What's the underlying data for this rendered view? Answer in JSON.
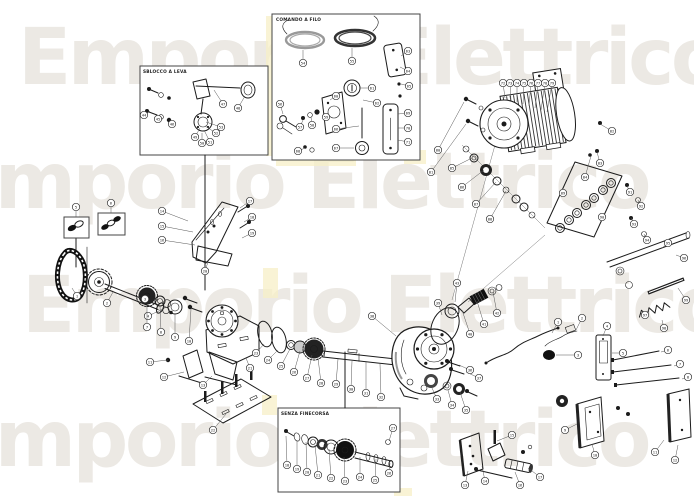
{
  "watermark": {
    "text": "Emporio Elettrico",
    "color": "#ece9e4"
  },
  "insets": [
    {
      "id": "lever-release",
      "label": "SBLOCCO A LEVA"
    },
    {
      "id": "cable-release",
      "label": "COMANDO A FILO"
    },
    {
      "id": "no-limit-switch",
      "label": "SENZA FINECORSA"
    }
  ],
  "diagram": {
    "kind": "exploded-parts-diagram",
    "line_color": "#1b1b1b",
    "highlight_color": "#f7efc7"
  },
  "balloons": [
    {
      "n": "1",
      "x": 77,
      "y": 296,
      "l": [
        72,
        288
      ]
    },
    {
      "n": "2",
      "x": 107,
      "y": 303,
      "l": [
        113,
        292
      ]
    },
    {
      "n": "3",
      "x": 145,
      "y": 299,
      "l": [
        136,
        297
      ]
    },
    {
      "n": "4",
      "x": 148,
      "y": 316,
      "l": [
        163,
        309
      ]
    },
    {
      "n": "5",
      "x": 76,
      "y": 207,
      "l": [
        76,
        217
      ]
    },
    {
      "n": "6",
      "x": 111,
      "y": 203,
      "l": [
        111,
        213
      ]
    },
    {
      "n": "7",
      "x": 147,
      "y": 327,
      "l": [
        147,
        306
      ]
    },
    {
      "n": "8",
      "x": 161,
      "y": 332,
      "l": [
        160,
        306
      ]
    },
    {
      "n": "9",
      "x": 175,
      "y": 337,
      "l": [
        175,
        314
      ]
    },
    {
      "n": "10",
      "x": 189,
      "y": 341,
      "l": [
        191,
        309
      ]
    },
    {
      "n": "11",
      "x": 150,
      "y": 362,
      "l": [
        168,
        360
      ]
    },
    {
      "n": "12",
      "x": 164,
      "y": 377,
      "l": [
        184,
        372
      ]
    },
    {
      "n": "13",
      "x": 203,
      "y": 385,
      "l": [
        212,
        376
      ]
    },
    {
      "n": "14",
      "x": 162,
      "y": 211,
      "l": [
        188,
        221
      ]
    },
    {
      "n": "15",
      "x": 162,
      "y": 226,
      "l": [
        193,
        232
      ]
    },
    {
      "n": "16",
      "x": 162,
      "y": 240,
      "l": [
        195,
        245
      ]
    },
    {
      "n": "17",
      "x": 250,
      "y": 201,
      "l": [
        240,
        208
      ]
    },
    {
      "n": "18",
      "x": 252,
      "y": 217,
      "l": [
        244,
        222
      ]
    },
    {
      "n": "19",
      "x": 252,
      "y": 233,
      "l": [
        242,
        238
      ]
    },
    {
      "n": "20",
      "x": 205,
      "y": 271,
      "l": [
        208,
        262
      ]
    },
    {
      "n": "21",
      "x": 250,
      "y": 368,
      "l": [
        246,
        358
      ]
    },
    {
      "n": "22",
      "x": 213,
      "y": 430,
      "l": [
        226,
        414
      ]
    },
    {
      "n": "23",
      "x": 256,
      "y": 353,
      "l": [
        264,
        344
      ]
    },
    {
      "n": "24",
      "x": 268,
      "y": 360,
      "l": [
        278,
        350
      ]
    },
    {
      "n": "25",
      "x": 281,
      "y": 366,
      "l": [
        290,
        349
      ]
    },
    {
      "n": "26",
      "x": 294,
      "y": 372,
      "l": [
        300,
        351
      ]
    },
    {
      "n": "27",
      "x": 307,
      "y": 378,
      "l": [
        312,
        355
      ]
    },
    {
      "n": "28",
      "x": 321,
      "y": 383,
      "l": [
        318,
        358
      ]
    },
    {
      "n": "29",
      "x": 336,
      "y": 384,
      "l": [
        338,
        359
      ]
    },
    {
      "n": "30",
      "x": 351,
      "y": 389,
      "l": [
        352,
        361
      ]
    },
    {
      "n": "31",
      "x": 366,
      "y": 393,
      "l": [
        366,
        362
      ]
    },
    {
      "n": "32",
      "x": 381,
      "y": 397,
      "l": [
        380,
        364
      ]
    },
    {
      "n": "33",
      "x": 437,
      "y": 399,
      "l": [
        432,
        388
      ]
    },
    {
      "n": "34",
      "x": 452,
      "y": 405,
      "l": [
        448,
        390
      ]
    },
    {
      "n": "35",
      "x": 466,
      "y": 410,
      "l": [
        460,
        392
      ]
    },
    {
      "n": "36",
      "x": 470,
      "y": 370,
      "l": [
        459,
        365
      ]
    },
    {
      "n": "37",
      "x": 479,
      "y": 378,
      "l": [
        466,
        372
      ]
    },
    {
      "n": "38",
      "x": 372,
      "y": 316,
      "l": [
        396,
        336
      ]
    },
    {
      "n": "39",
      "x": 438,
      "y": 303,
      "l": [
        442,
        315
      ]
    },
    {
      "n": "40",
      "x": 470,
      "y": 334,
      "l": [
        462,
        310
      ]
    },
    {
      "n": "41",
      "x": 484,
      "y": 324,
      "l": [
        477,
        301
      ]
    },
    {
      "n": "42",
      "x": 497,
      "y": 313,
      "l": [
        493,
        292
      ]
    },
    {
      "n": "43",
      "x": 457,
      "y": 283,
      "l": [
        455,
        302
      ]
    },
    {
      "n": "44",
      "x": 144,
      "y": 115,
      "l": [
        150,
        111
      ]
    },
    {
      "n": "45",
      "x": 158,
      "y": 119,
      "l": [
        161,
        116
      ]
    },
    {
      "n": "46",
      "x": 172,
      "y": 124,
      "l": [
        170,
        120
      ]
    },
    {
      "n": "47",
      "x": 223,
      "y": 104,
      "l": [
        214,
        90
      ]
    },
    {
      "n": "48",
      "x": 238,
      "y": 108,
      "l": [
        245,
        96
      ]
    },
    {
      "n": "49",
      "x": 195,
      "y": 137,
      "l": [
        200,
        128
      ]
    },
    {
      "n": "50",
      "x": 202,
      "y": 143,
      "l": [
        202,
        133
      ]
    },
    {
      "n": "51",
      "x": 210,
      "y": 142,
      "l": [
        204,
        130
      ]
    },
    {
      "n": "52",
      "x": 216,
      "y": 133,
      "l": [
        205,
        126
      ]
    },
    {
      "n": "53",
      "x": 221,
      "y": 127,
      "l": [
        206,
        122
      ]
    },
    {
      "n": "54",
      "x": 303,
      "y": 63,
      "l": [
        303,
        50
      ]
    },
    {
      "n": "55",
      "x": 352,
      "y": 61,
      "l": [
        352,
        48
      ]
    },
    {
      "n": "56",
      "x": 280,
      "y": 104,
      "l": [
        283,
        114
      ]
    },
    {
      "n": "57",
      "x": 300,
      "y": 127,
      "l": [
        303,
        120
      ]
    },
    {
      "n": "58",
      "x": 312,
      "y": 125,
      "l": [
        311,
        117
      ]
    },
    {
      "n": "59",
      "x": 326,
      "y": 117
    },
    {
      "n": "60",
      "x": 336,
      "y": 96,
      "l": [
        330,
        100
      ]
    },
    {
      "n": "61",
      "x": 372,
      "y": 88,
      "l": [
        360,
        88
      ]
    },
    {
      "n": "62",
      "x": 377,
      "y": 103,
      "l": [
        363,
        100
      ]
    },
    {
      "n": "63",
      "x": 408,
      "y": 51,
      "l": [
        401,
        56
      ]
    },
    {
      "n": "64",
      "x": 408,
      "y": 71,
      "l": [
        400,
        67
      ]
    },
    {
      "n": "65",
      "x": 409,
      "y": 86,
      "l": [
        401,
        84
      ]
    },
    {
      "n": "66",
      "x": 336,
      "y": 129,
      "l": [
        359,
        126
      ]
    },
    {
      "n": "67",
      "x": 336,
      "y": 148,
      "l": [
        354,
        148
      ]
    },
    {
      "n": "68",
      "x": 298,
      "y": 151,
      "l": [
        305,
        148
      ]
    },
    {
      "n": "69",
      "x": 408,
      "y": 113,
      "l": [
        398,
        114
      ]
    },
    {
      "n": "70",
      "x": 408,
      "y": 128,
      "l": [
        398,
        128
      ]
    },
    {
      "n": "71",
      "x": 408,
      "y": 142,
      "l": [
        398,
        140
      ]
    },
    {
      "n": "72",
      "x": 503,
      "y": 83,
      "l": [
        505,
        98
      ]
    },
    {
      "n": "73",
      "x": 510,
      "y": 83,
      "l": [
        511,
        100
      ]
    },
    {
      "n": "74",
      "x": 517,
      "y": 83,
      "l": [
        517,
        102
      ]
    },
    {
      "n": "75",
      "x": 524,
      "y": 83,
      "l": [
        523,
        104
      ]
    },
    {
      "n": "76",
      "x": 531,
      "y": 83,
      "l": [
        529,
        106
      ]
    },
    {
      "n": "77",
      "x": 538,
      "y": 83,
      "l": [
        535,
        108
      ]
    },
    {
      "n": "78",
      "x": 545,
      "y": 83,
      "l": [
        541,
        110
      ]
    },
    {
      "n": "79",
      "x": 552,
      "y": 83,
      "l": [
        547,
        112
      ]
    },
    {
      "n": "80",
      "x": 438,
      "y": 150,
      "l": [
        464,
        102
      ]
    },
    {
      "n": "81",
      "x": 431,
      "y": 172,
      "l": [
        466,
        124
      ]
    },
    {
      "n": "82",
      "x": 612,
      "y": 131,
      "l": [
        600,
        124
      ]
    },
    {
      "n": "83",
      "x": 600,
      "y": 163,
      "l": [
        597,
        152
      ]
    },
    {
      "n": "84",
      "x": 585,
      "y": 177,
      "l": [
        591,
        156
      ]
    },
    {
      "n": "85",
      "x": 452,
      "y": 168,
      "l": [
        472,
        158
      ]
    },
    {
      "n": "86",
      "x": 462,
      "y": 187,
      "l": [
        484,
        170
      ]
    },
    {
      "n": "87",
      "x": 476,
      "y": 204,
      "l": [
        496,
        182
      ]
    },
    {
      "n": "88",
      "x": 490,
      "y": 219,
      "l": [
        506,
        191
      ]
    },
    {
      "n": "89",
      "x": 563,
      "y": 193
    },
    {
      "n": "90",
      "x": 602,
      "y": 217
    },
    {
      "n": "91",
      "x": 630,
      "y": 192,
      "l": [
        627,
        186
      ]
    },
    {
      "n": "92",
      "x": 641,
      "y": 206,
      "l": [
        638,
        200
      ]
    },
    {
      "n": "93",
      "x": 634,
      "y": 224,
      "l": [
        631,
        218
      ]
    },
    {
      "n": "94",
      "x": 647,
      "y": 240,
      "l": [
        644,
        234
      ]
    },
    {
      "n": "95",
      "x": 668,
      "y": 243,
      "l": [
        662,
        248
      ]
    },
    {
      "n": "96",
      "x": 684,
      "y": 258,
      "l": [
        676,
        255
      ]
    },
    {
      "n": "97",
      "x": 645,
      "y": 315,
      "l": [
        650,
        308
      ]
    },
    {
      "n": "98",
      "x": 664,
      "y": 328,
      "l": [
        662,
        320
      ]
    },
    {
      "n": "99",
      "x": 686,
      "y": 300,
      "l": [
        678,
        288
      ]
    },
    {
      "n": "1",
      "x": 558,
      "y": 322,
      "l": [
        552,
        333
      ]
    },
    {
      "n": "2",
      "x": 582,
      "y": 318,
      "l": [
        576,
        330
      ]
    },
    {
      "n": "3",
      "x": 578,
      "y": 355,
      "l": [
        556,
        355
      ]
    },
    {
      "n": "4",
      "x": 607,
      "y": 326,
      "l": [
        603,
        336
      ]
    },
    {
      "n": "5",
      "x": 623,
      "y": 353,
      "l": [
        612,
        353
      ]
    },
    {
      "n": "6",
      "x": 668,
      "y": 350,
      "l": [
        661,
        352
      ]
    },
    {
      "n": "7",
      "x": 680,
      "y": 364,
      "l": [
        674,
        366
      ]
    },
    {
      "n": "8",
      "x": 688,
      "y": 377,
      "l": [
        682,
        379
      ]
    },
    {
      "n": "9",
      "x": 565,
      "y": 430,
      "l": [
        577,
        424
      ]
    },
    {
      "n": "10",
      "x": 595,
      "y": 455,
      "l": [
        592,
        444
      ]
    },
    {
      "n": "11",
      "x": 655,
      "y": 452,
      "l": [
        664,
        440
      ]
    },
    {
      "n": "12",
      "x": 675,
      "y": 460,
      "l": [
        678,
        445
      ]
    },
    {
      "n": "13",
      "x": 465,
      "y": 485,
      "l": [
        468,
        471
      ]
    },
    {
      "n": "14",
      "x": 485,
      "y": 481,
      "l": [
        482,
        466
      ]
    },
    {
      "n": "15",
      "x": 512,
      "y": 435,
      "l": [
        497,
        441
      ]
    },
    {
      "n": "16",
      "x": 520,
      "y": 485,
      "l": [
        515,
        472
      ]
    },
    {
      "n": "17",
      "x": 540,
      "y": 477,
      "l": [
        528,
        468
      ]
    },
    {
      "n": "18",
      "x": 287,
      "y": 465,
      "l": [
        286,
        436
      ]
    },
    {
      "n": "19",
      "x": 297,
      "y": 469,
      "l": [
        297,
        440
      ]
    },
    {
      "n": "20",
      "x": 307,
      "y": 472,
      "l": [
        306,
        442
      ]
    },
    {
      "n": "21",
      "x": 318,
      "y": 475,
      "l": [
        315,
        445
      ]
    },
    {
      "n": "22",
      "x": 331,
      "y": 478,
      "l": [
        329,
        449
      ]
    },
    {
      "n": "23",
      "x": 345,
      "y": 481,
      "l": [
        344,
        457
      ]
    },
    {
      "n": "24",
      "x": 360,
      "y": 477,
      "l": [
        360,
        457
      ]
    },
    {
      "n": "25",
      "x": 375,
      "y": 480,
      "l": [
        376,
        459
      ]
    },
    {
      "n": "26",
      "x": 389,
      "y": 473,
      "l": [
        390,
        463
      ]
    },
    {
      "n": "27",
      "x": 393,
      "y": 428,
      "l": [
        389,
        441
      ]
    }
  ]
}
